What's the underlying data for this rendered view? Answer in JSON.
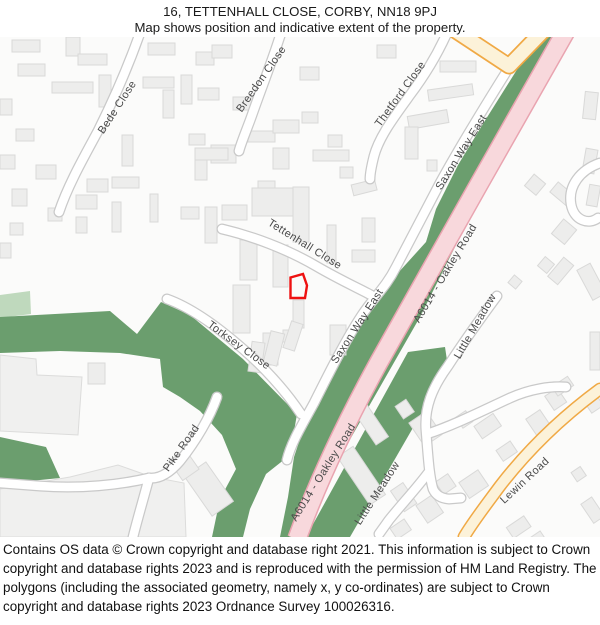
{
  "header": {
    "title": "16, TETTENHALL CLOSE, CORBY, NN18 9PJ",
    "subtitle": "Map shows position and indicative extent of the property."
  },
  "map": {
    "road_labels": {
      "bede": "Bede Close",
      "breedon": "Breedon Close",
      "thetford": "Thetford Close",
      "saxon_top": "Saxon Way East",
      "saxon_mid": "Saxon Way East",
      "tettenhall": "Tettenhall Close",
      "torksey": "Torksey Close",
      "a6014_top": "A6014 - Oakley Road",
      "a6014_bottom": "A6014 - Oakley Road",
      "little_meadow_top": "Little Meadow",
      "little_meadow_bottom": "Little Meadow",
      "lewin": "Lewin Road",
      "pike": "Pike Road"
    },
    "colors": {
      "map_background": "#fbfbfa",
      "woodland_green": "#6b9e6e",
      "pale_green": "#bfd9bd",
      "a_road_fill": "#f8d8dc",
      "a_road_border": "#e9a4b0",
      "minor_road_fill": "#fcf2d9",
      "minor_road_border": "#f0a945",
      "road_casing": "#c9c9c9",
      "building_fill": "#ededec",
      "building_border": "#d9d9d8",
      "label_text": "#4a4a4a",
      "property_outline_red": "#ee1111"
    }
  },
  "footer": {
    "copyright": "Contains OS data © Crown copyright and database right 2021. This information is subject to Crown copyright and database rights 2023 and is reproduced with the permission of HM Land Registry. The polygons (including the associated geometry, namely x, y co-ordinates) are subject to Crown copyright and database rights 2023 Ordnance Survey 100026316."
  }
}
